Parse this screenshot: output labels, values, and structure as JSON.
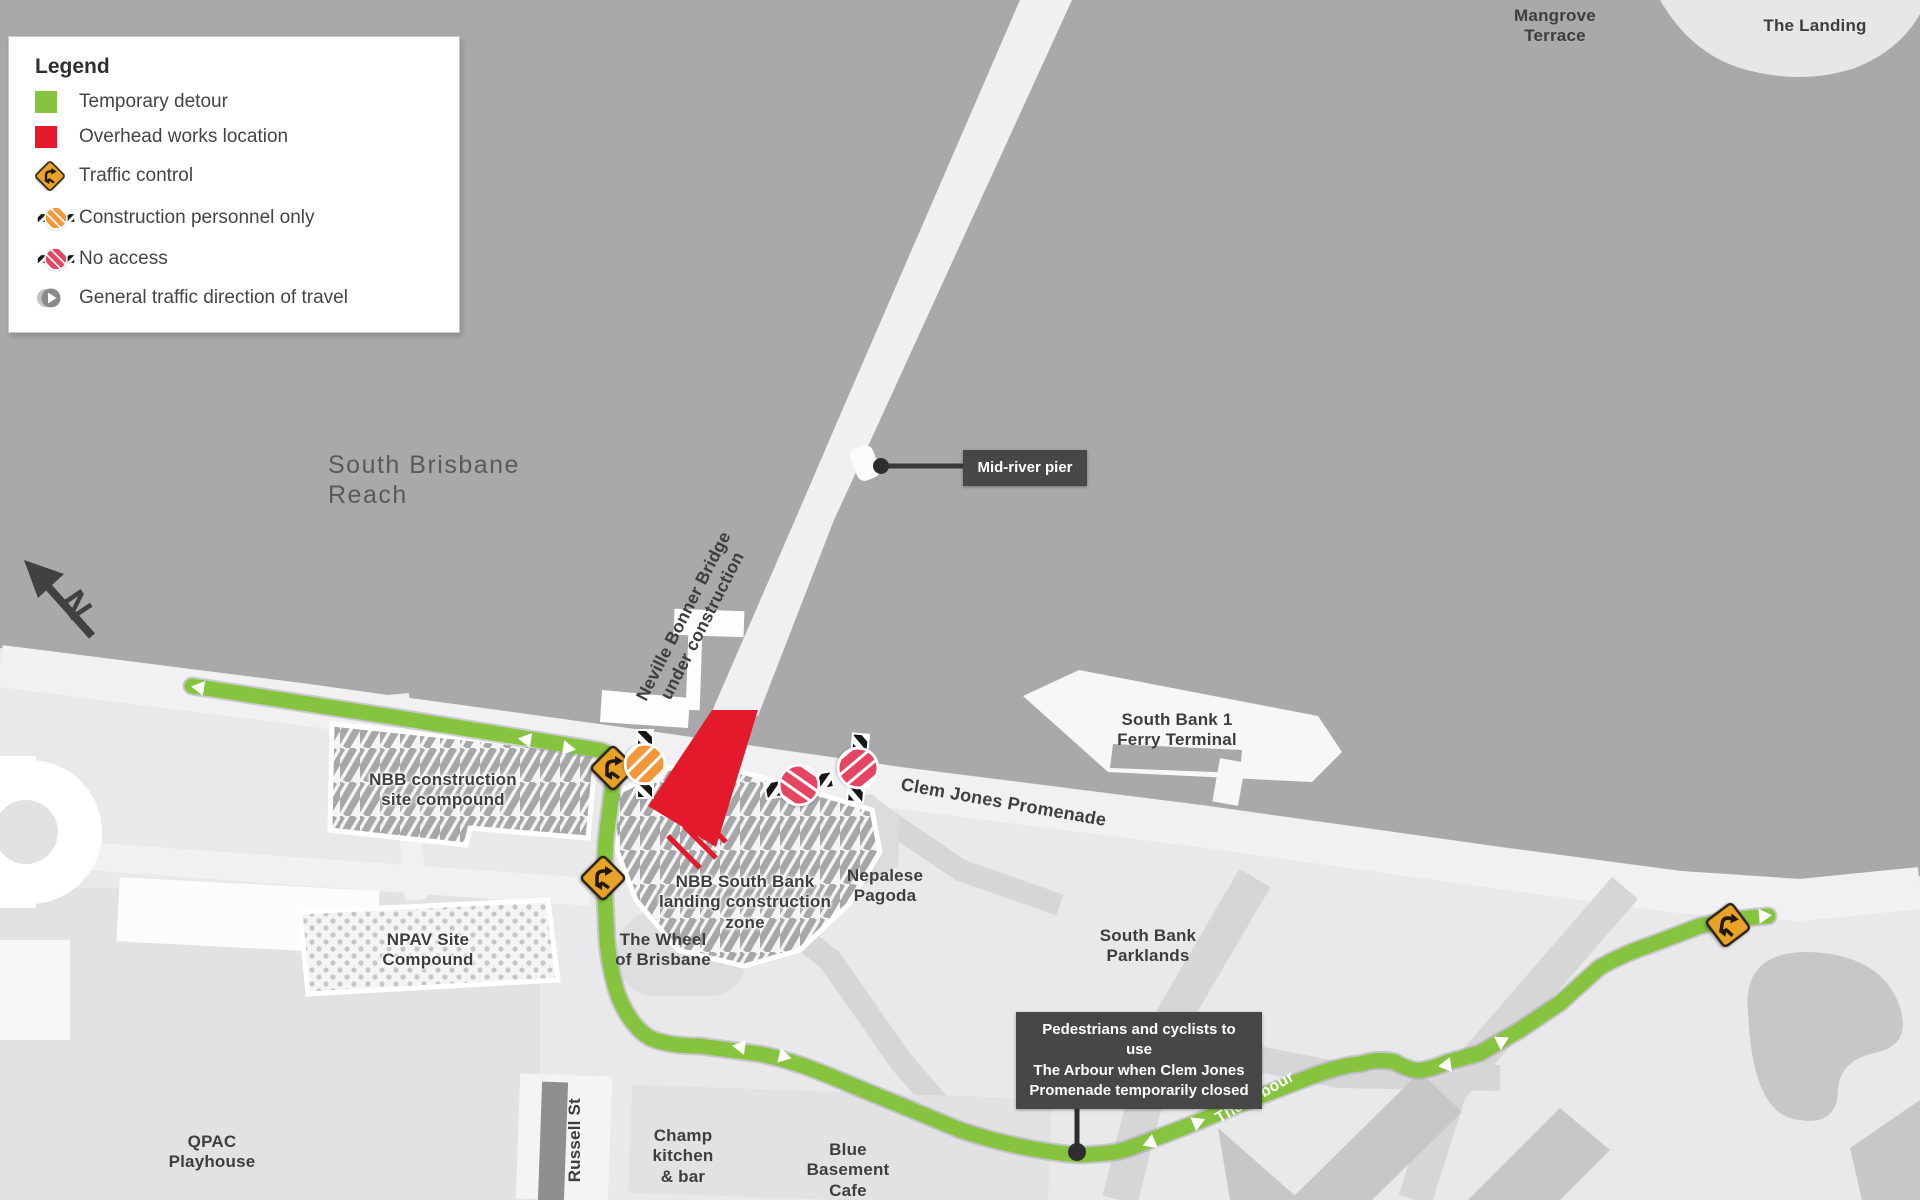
{
  "legend": {
    "title": "Legend",
    "items": [
      {
        "icon": "temporary-detour-swatch",
        "label": "Temporary detour"
      },
      {
        "icon": "overhead-works-swatch",
        "label": "Overhead works location"
      },
      {
        "icon": "traffic-control-icon",
        "label": "Traffic control"
      },
      {
        "icon": "construction-personnel-icon",
        "label": "Construction personnel only"
      },
      {
        "icon": "no-access-icon",
        "label": "No access"
      },
      {
        "icon": "traffic-direction-icon",
        "label": "General traffic direction of travel"
      }
    ]
  },
  "compass": {
    "label": "N"
  },
  "callouts": {
    "mid_river_pier": "Mid-river pier",
    "arbour_note": "Pedestrians and cyclists to use\nThe Arbour when Clem Jones\nPromenade temporarily closed"
  },
  "map_labels": {
    "south_brisbane_reach": "South Brisbane Reach",
    "mangrove_terrace": "Mangrove\nTerrace",
    "the_landing": "The Landing",
    "neville_bonner_bridge": "Neville Bonner Bridge\nunder construction",
    "south_bank_1_ferry_terminal": "South Bank 1\nFerry Terminal",
    "clem_jones_promenade": "Clem Jones Promenade",
    "nbb_construction_site_compound": "NBB construction\nsite compound",
    "nbb_south_bank_landing": "NBB South Bank\nlanding construction\nzone",
    "nepalese_pagoda": "Nepalese\nPagoda",
    "the_wheel_of_brisbane": "The Wheel\nof Brisbane",
    "npav_site_compound": "NPAV Site\nCompound",
    "south_bank_parklands": "South Bank\nParklands",
    "qpac_playhouse": "QPAC\nPlayhouse",
    "russell_st": "Russell St",
    "champ_kitchen": "Champ\nkitchen\n& bar",
    "blue_basement_cafe": "Blue\nBasement\nCafe",
    "the_arbour": "The Arbour"
  },
  "colors": {
    "temporary_detour_green": "#86C440",
    "overhead_works_red": "#E5192C",
    "traffic_control_yellow": "#E8A227",
    "no_access_red": "#E64561",
    "construction_personnel_orange": "#F2983B",
    "river_grey": "#A9A9AB",
    "land_grey": "#E9E9EB",
    "callout_grey": "#474748"
  }
}
